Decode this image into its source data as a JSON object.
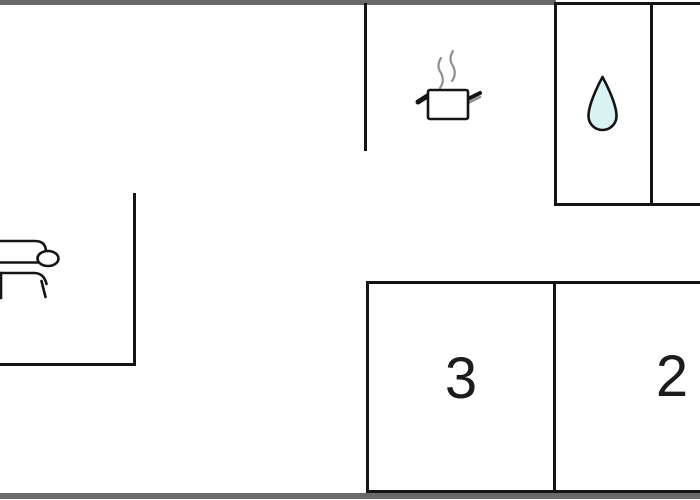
{
  "page": {
    "type": "floor-plan-drawing",
    "background": "#ffffff"
  },
  "colors": {
    "wall": "#141414",
    "exterior_bar": "#696969",
    "drop_fill": "#d9f4f2",
    "drop_stroke": "#141414",
    "steam": "#8f8f8f",
    "pot_outline": "#141414",
    "room_label": "#1c1c1c"
  },
  "icons": {
    "sofa": "sofa-icon",
    "pot": "cooking-pot-icon",
    "drop": "water-drop-icon"
  },
  "rooms": {
    "room3": {
      "label": "3"
    },
    "room2": {
      "label": "2"
    }
  }
}
